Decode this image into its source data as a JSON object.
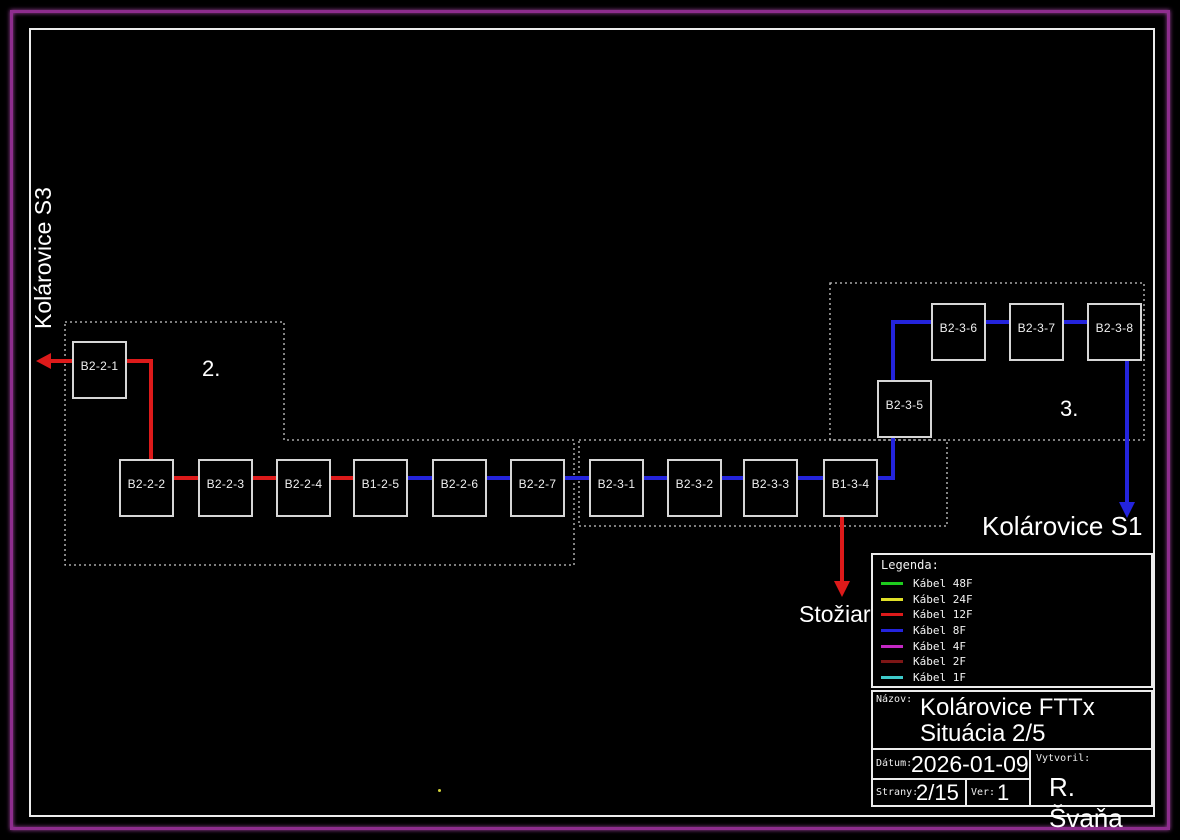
{
  "page": {
    "background": "#000000",
    "outer_border_color": "#8e2d8e",
    "inner_border_color": "#ececec"
  },
  "labels": {
    "left_area": "Kolárovice S3",
    "right_area": "Kolárovice S1",
    "mast": "Stožiar",
    "area2": "2.",
    "area3": "3."
  },
  "diagram": {
    "node_size": {
      "w": 55,
      "h": 58
    },
    "colors": {
      "red": "#dd1a1a",
      "blue": "#2424dd"
    },
    "nodes": [
      {
        "id": "B2-2-1",
        "x": 72,
        "y": 341
      },
      {
        "id": "B2-2-2",
        "x": 119,
        "y": 459
      },
      {
        "id": "B2-2-3",
        "x": 198,
        "y": 459
      },
      {
        "id": "B2-2-4",
        "x": 276,
        "y": 459
      },
      {
        "id": "B1-2-5",
        "x": 353,
        "y": 459
      },
      {
        "id": "B2-2-6",
        "x": 432,
        "y": 459
      },
      {
        "id": "B2-2-7",
        "x": 510,
        "y": 459
      },
      {
        "id": "B2-3-1",
        "x": 589,
        "y": 459
      },
      {
        "id": "B2-3-2",
        "x": 667,
        "y": 459
      },
      {
        "id": "B2-3-3",
        "x": 743,
        "y": 459
      },
      {
        "id": "B1-3-4",
        "x": 823,
        "y": 459
      },
      {
        "id": "B2-3-5",
        "x": 877,
        "y": 380
      },
      {
        "id": "B2-3-6",
        "x": 931,
        "y": 303
      },
      {
        "id": "B2-3-7",
        "x": 1009,
        "y": 303
      },
      {
        "id": "B2-3-8",
        "x": 1087,
        "y": 303
      }
    ],
    "segments": [
      {
        "x1": 47,
        "y1": 361,
        "x2": 72,
        "y2": 361,
        "c": "red"
      },
      {
        "x1": 127,
        "y1": 361,
        "x2": 151,
        "y2": 361,
        "c": "red"
      },
      {
        "x1": 151,
        "y1": 361,
        "x2": 151,
        "y2": 461,
        "c": "red"
      },
      {
        "x1": 174,
        "y1": 478,
        "x2": 198,
        "y2": 478,
        "c": "red"
      },
      {
        "x1": 253,
        "y1": 478,
        "x2": 276,
        "y2": 478,
        "c": "red"
      },
      {
        "x1": 331,
        "y1": 478,
        "x2": 353,
        "y2": 478,
        "c": "red"
      },
      {
        "x1": 842,
        "y1": 517,
        "x2": 842,
        "y2": 582,
        "c": "red"
      },
      {
        "x1": 408,
        "y1": 478,
        "x2": 432,
        "y2": 478,
        "c": "blue"
      },
      {
        "x1": 487,
        "y1": 478,
        "x2": 510,
        "y2": 478,
        "c": "blue"
      },
      {
        "x1": 565,
        "y1": 478,
        "x2": 589,
        "y2": 478,
        "c": "blue"
      },
      {
        "x1": 644,
        "y1": 478,
        "x2": 667,
        "y2": 478,
        "c": "blue"
      },
      {
        "x1": 722,
        "y1": 478,
        "x2": 743,
        "y2": 478,
        "c": "blue"
      },
      {
        "x1": 798,
        "y1": 478,
        "x2": 823,
        "y2": 478,
        "c": "blue"
      },
      {
        "x1": 878,
        "y1": 478,
        "x2": 893,
        "y2": 478,
        "c": "blue"
      },
      {
        "x1": 893,
        "y1": 478,
        "x2": 893,
        "y2": 438,
        "c": "blue"
      },
      {
        "x1": 893,
        "y1": 380,
        "x2": 893,
        "y2": 322,
        "c": "blue"
      },
      {
        "x1": 893,
        "y1": 322,
        "x2": 931,
        "y2": 322,
        "c": "blue"
      },
      {
        "x1": 986,
        "y1": 322,
        "x2": 1009,
        "y2": 322,
        "c": "blue"
      },
      {
        "x1": 1064,
        "y1": 322,
        "x2": 1087,
        "y2": 322,
        "c": "blue"
      },
      {
        "x1": 1127,
        "y1": 361,
        "x2": 1127,
        "y2": 503,
        "c": "blue"
      }
    ],
    "arrows": [
      {
        "name": "arrow-to-kolarovice-s3",
        "dir": "left",
        "x": 36,
        "y": 361,
        "c": "red"
      },
      {
        "name": "arrow-to-stoziar",
        "dir": "down",
        "x": 842,
        "y": 597,
        "c": "red"
      },
      {
        "name": "arrow-to-kolarovice-s1",
        "dir": "down",
        "x": 1127,
        "y": 518,
        "c": "blue"
      }
    ],
    "regions": [
      {
        "id": "area-2",
        "points": "65,322 284,322 284,440 574,440 574,565 65,565"
      },
      {
        "id": "area-middle",
        "points": "579,440 947,440 947,526 579,526"
      },
      {
        "id": "area-3",
        "points": "830,283 1144,283 1144,440 830,440"
      }
    ],
    "dot": {
      "x": 438,
      "y": 789,
      "color": "#d4d43a"
    }
  },
  "legend": {
    "title": "Legenda:",
    "items": [
      {
        "label": "Kábel 48F",
        "color": "#1ecc1e"
      },
      {
        "label": "Kábel 24F",
        "color": "#e0e028"
      },
      {
        "label": "Kábel 12F",
        "color": "#dd1a1a"
      },
      {
        "label": "Kábel 8F",
        "color": "#2424dd"
      },
      {
        "label": "Kábel 4F",
        "color": "#c428c4"
      },
      {
        "label": "Kábel 2F",
        "color": "#7d1616"
      },
      {
        "label": "Kábel 1F",
        "color": "#3ecaca"
      }
    ]
  },
  "title_block": {
    "nazov_label": "Názov:",
    "nazov_line1": "Kolárovice FTTx",
    "nazov_line2": "Situácia 2/5",
    "datum_label": "Dátum:",
    "datum": "2026-01-09",
    "vytvoril_label": "Vytvoril:",
    "vytvoril": "R. Švaňa",
    "strany_label": "Strany:",
    "strany": "2/15",
    "ver_label": "Ver:",
    "ver": "1"
  }
}
